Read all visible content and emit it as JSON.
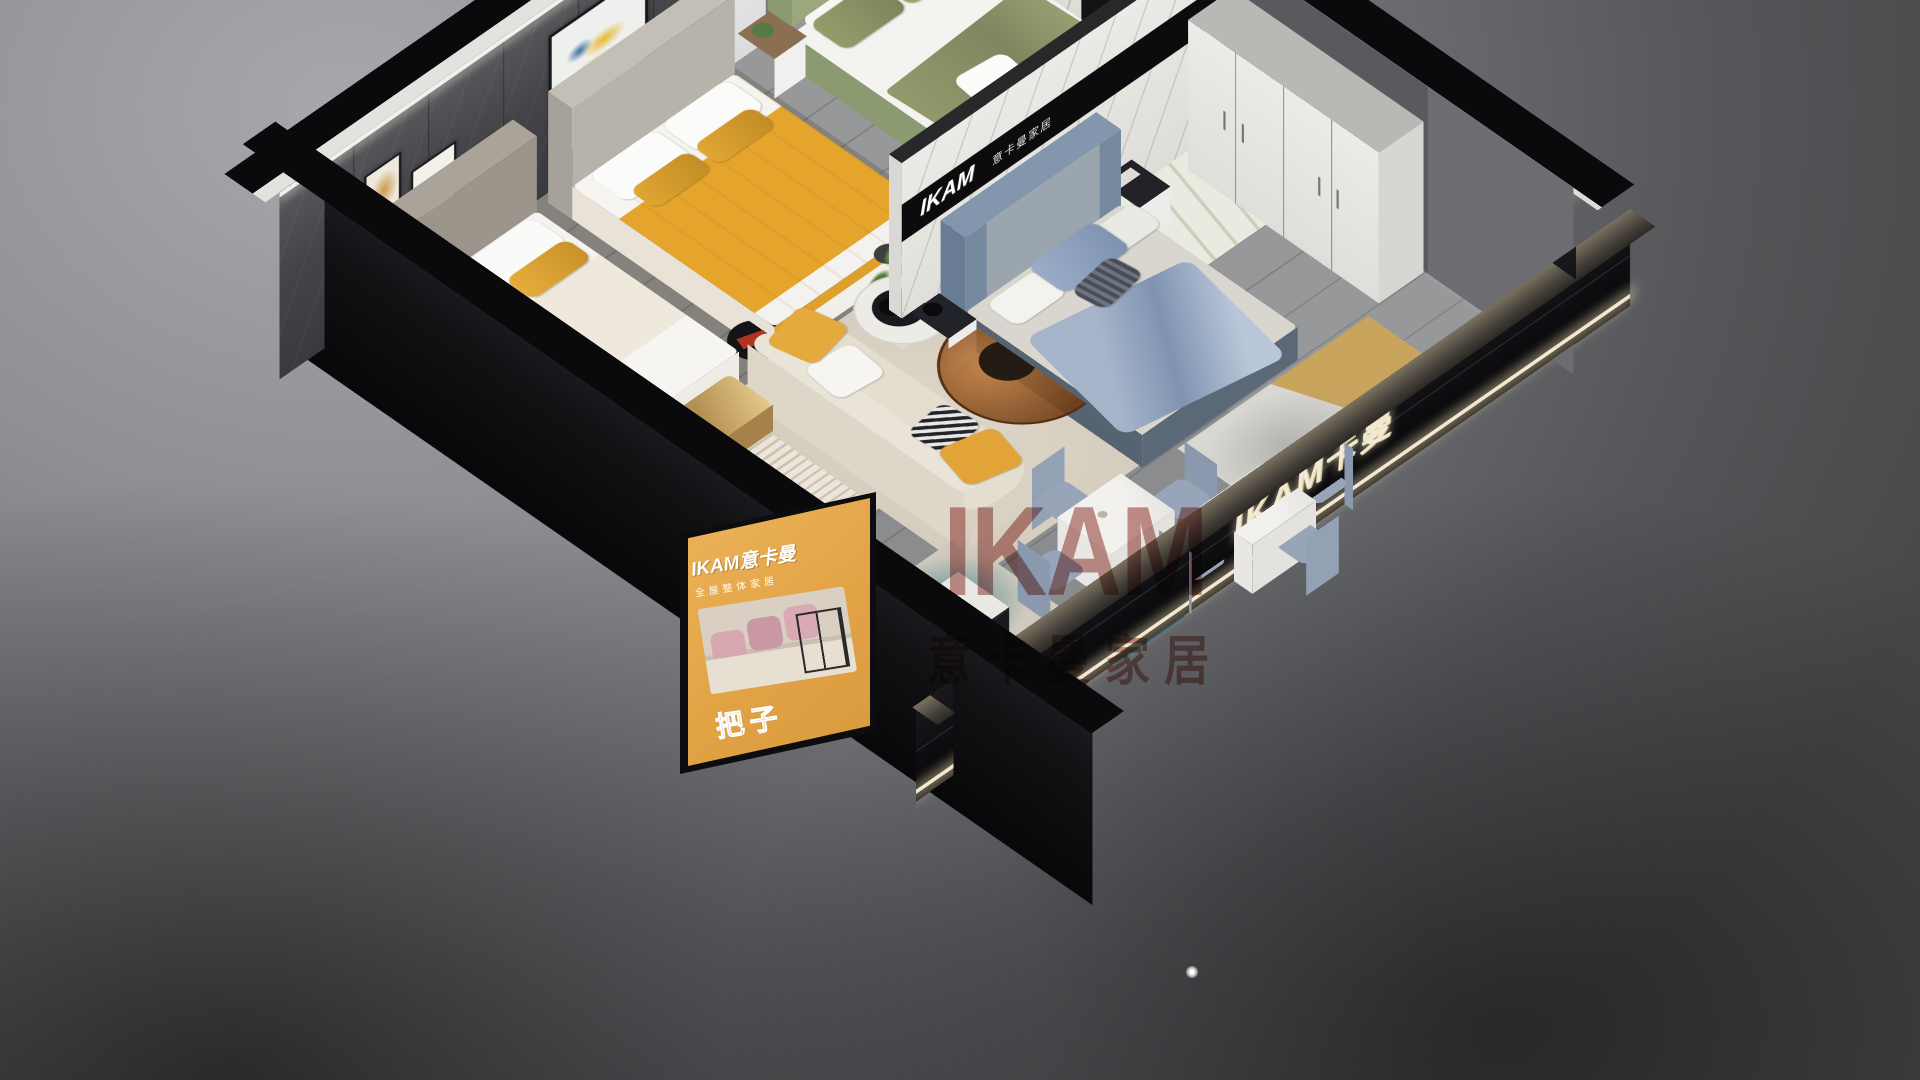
{
  "scene_type": "3D isometric cutaway render of a furniture showroom apartment",
  "brand": "IKAM",
  "watermark": {
    "line1": "IKAM",
    "line2": "意卡曼家居",
    "color": "#8e2620"
  },
  "signs": {
    "marble_band": {
      "brand": "IKAM",
      "suffix": "意卡曼家居",
      "bg": "#0c0c0e",
      "color": "#ffffff"
    },
    "ne_wall": {
      "text": "IKAM 意卡曼家居"
    },
    "glass_wall": {
      "text": "IKAM卡曼",
      "color": "#f3ead2"
    },
    "poster": {
      "title": "IKAM意卡曼",
      "subtitle": "全屋整体家居",
      "caption": "把子",
      "bg": "#e7aa4d"
    },
    "frame_joy": {
      "text": "Joy"
    }
  },
  "rooms": [
    "beige bedroom",
    "yellow bedroom",
    "green bedroom",
    "blue bedroom",
    "living lounge with cream sofa",
    "dining area",
    "tv lounge corner"
  ],
  "gallery_frames": [
    "pattern",
    "dots",
    "dark-poster",
    "botanical",
    "Joy-script",
    "deer-art",
    "teal-poster"
  ],
  "palette": {
    "accent_yellow": "#e5a52d",
    "sofa_cream": "#e4decf",
    "bed_green": "#9aa87c",
    "bed_blue": "#8ea2c0",
    "stone_wall": "#47474a",
    "floor_grey": "#8e9092",
    "marble": "#e8e7e3",
    "glass_black": "#0b0b0e",
    "dining_chair_blue": "#98a5b8"
  }
}
